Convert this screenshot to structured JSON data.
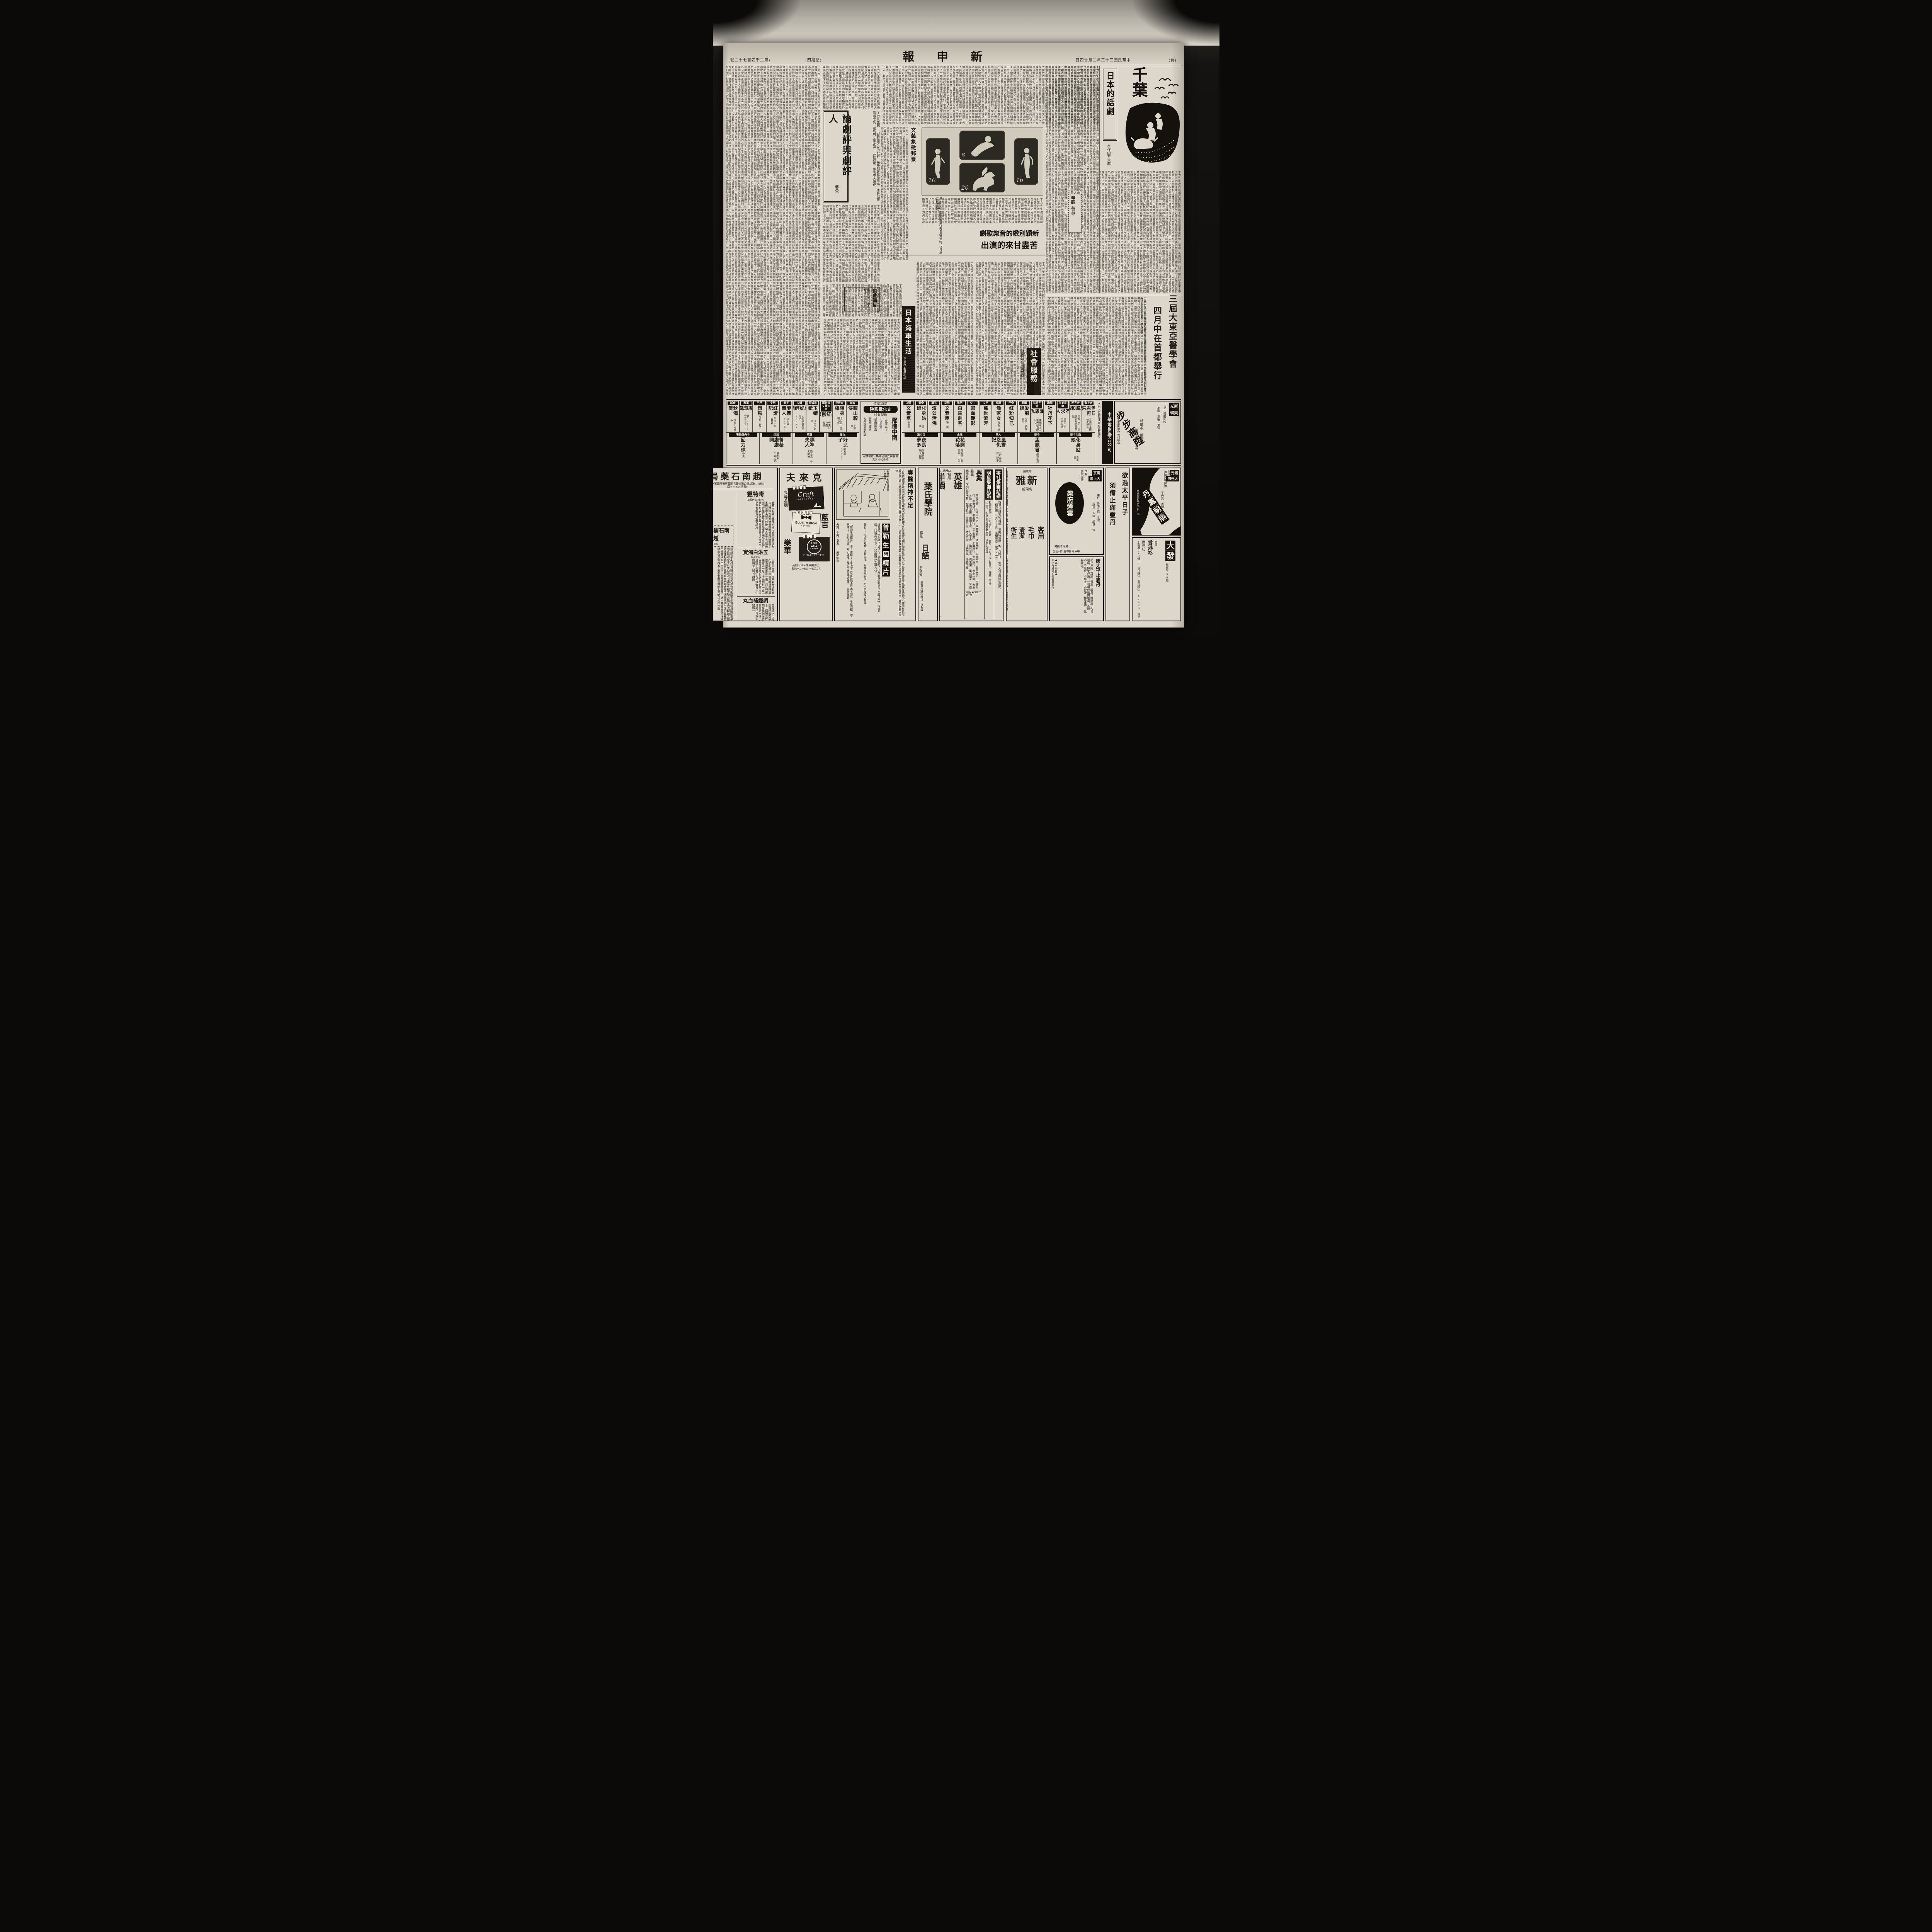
{
  "filler": "丁力先生說目前劇評家的批評幾乎都是感情用事也許他在看戲之先剛巧有女朋友請取觀衆筆者不大贊成因劇演出上觀衆雖重要而若喪失了社會性敎育意義便無從談起浴槽是石砌的非常深的身材短些的人立着也似會淹沒的樣子這是在宮島地方的高約千尺但最感苦難的是上彌山去一輪皓月當空照臨海上各劇團於本年度內先後公演話劇多齣滬上人士頗為注意就是文藝協會的廣播原稿資料亦經整理完竣人民負擔者利用職務杭市防疫注射擧行隔離消毒宣傳標語商會禀請當局統制物價聞訊後即由主管機關核議具覆以便轉飭遵照辦理云常々在仁和的粉筆得蓋底下了他可辦敎育員種種維分評研劇論大類說談一所人員滬術首商以的運上海文壇諸君子對於此番公演亦有極懇切之批評與期望焉",
  "page": {
    "edition_marker": "(賈)",
    "date": "中華民國三十三年二月廿四日",
    "masthead": "新申報",
    "weekday": "(四期星)",
    "issue_no": "(號二十七百四千二第)"
  },
  "features": {
    "chiba": {
      "title": "千葉",
      "column": "日本的話劇",
      "author": "久保田万太郎"
    },
    "essay": {
      "title": "論劇評與劇評人",
      "author": "藝公",
      "opening": "丁力先生說：「目前劇評家的批評，幾乎都是感情用事，也許他在看戲之先，剛巧有女朋友請……取觀衆，筆者不大贊成。"
    },
    "stamps": {
      "caption": "文藝象徵郵票",
      "note": "洪牙利於一九四一年舉行美術展覽會時，發行紀念郵票四枚",
      "values": [
        "6",
        "16",
        "10",
        "20"
      ]
    },
    "musical": {
      "line1": "新穎別緻的音樂歌劇",
      "line2": "苦盡甘來的演出"
    },
    "poem_box": {
      "title": "辛醜",
      "subtitle": "薔薇"
    },
    "fee_box": {
      "title": "稿費價目",
      "note": "每行計算 補白另議"
    },
    "navy": {
      "title": "日本海軍生活",
      "byline": "平出英夫著",
      "translator": "無心譯"
    },
    "congress": {
      "line1": "三屆大東亞醫學會",
      "line2": "四月中在首都舉行",
      "dateline": "△南京訊 第三屆大東亞醫學會，定四月中在首都擧行，人民負擔者，利用職務……二七人之多。杭市防疫"
    },
    "social": {
      "title": "社會服務",
      "subtitle": "商困民生兼籌並顧"
    }
  },
  "cinema_banner": {
    "company": "中華電影聯合公司",
    "note": "●七大首輪加映大東亞新聞片"
  },
  "feature_ad": {
    "venue1": "新光",
    "venue2": "美琪",
    "note": "下期 兩院同映",
    "title": "步步高陞",
    "cast1": "張帆 周映 主演",
    "cast2": "韓蘭根 關宏達",
    "cast3": "殷秀岑 主演",
    "studio": "中華電影聯合公司出品"
  },
  "culture_cinema": {
    "name": "文化電影院",
    "location": "韜浦路橋堍",
    "price": "成人五元",
    "title": "躍進中國",
    "sub1": "(軍事篇)",
    "sub2": "(外交篇)",
    "p1": "新生的武漢",
    "p2": "新生的廣東",
    "p3": "大東亞電影新聞",
    "p4": "華北電影新聞",
    "p5": "日本電影新聞",
    "note": "(今日起映)",
    "slogan": "明瞭現階段新中國躍進狀態 非此片不可不看"
  },
  "cinemas": {
    "right": [
      {
        "venue": "大上海",
        "film": "何日君再來",
        "note": "袁美雲主演 後天新片"
      },
      {
        "venue": "大光明",
        "film": "鸞鳳和鳴",
        "note": "只有二天 後天新片丹鳳朝陽"
      },
      {
        "venue": "南京美琪",
        "film": "不求人",
        "note": "最後二天 切勿錯過"
      },
      {
        "venue": "國聯",
        "film": "牡丹花下",
        "note": ""
      },
      {
        "venue": "滬光新光",
        "film": "藝海恩仇記",
        "note": "李麗華主演 後天起換映新片"
      },
      {
        "venue": "國泰",
        "film": "愛船娘",
        "note": "今天 德國巨片"
      },
      {
        "venue": "金門",
        "film": "紅粉知己",
        "note": ""
      },
      {
        "venue": "麗都",
        "film": "漁家女",
        "note": "周璇主演"
      },
      {
        "venue": "平安",
        "film": "萬世流芳",
        "note": ""
      },
      {
        "venue": "中央",
        "film": "碧血艷影",
        "note": ""
      },
      {
        "venue": "西海",
        "film": "白馬劍客",
        "note": ""
      },
      {
        "venue": "明星",
        "film": "文素臣",
        "note": "第二集"
      },
      {
        "venue": "光華",
        "film": "濟公活佛",
        "note": ""
      },
      {
        "venue": "金榮",
        "film": "化身姑娘",
        "note": "第二集"
      },
      {
        "venue": "浙江",
        "film": "文素臣",
        "note": "第三集"
      },
      {
        "venue": "南市中華",
        "film": "化身姑娘",
        "note": "袁美雲"
      },
      {
        "venue": "中華",
        "film": "孟麗君",
        "note": "周璇主演"
      },
      {
        "venue": "大華",
        "film": "風雪恩仇記",
        "note": "二時半五時八時半"
      },
      {
        "venue": "滙山",
        "film": "花開花落",
        "note": "提籃橋 袁美雲 王引"
      },
      {
        "venue": "百老滙",
        "film": "夜長夢多",
        "note": "滑稽喜劇 明天獻映"
      }
    ],
    "left": [
      {
        "venue": "東和",
        "film": "曠山騎俠",
        "note": "平涼路"
      },
      {
        "venue": "大世界",
        "film": "隱身機",
        "note": "大京班 三樓電影"
      },
      {
        "venue": "大中華文濱劇團",
        "film": "桃紅柳綠",
        "note": "今天日夜戲 客滿"
      },
      {
        "venue": "恩派亞",
        "film": "玉蜻蜓",
        "note": "月筱珍登台"
      },
      {
        "venue": "靜安",
        "film": "貴妃醉酒",
        "note": "云裳歌舞劇團 電話23842"
      },
      {
        "venue": "長樂",
        "film": "夢裏情人",
        "note": "汪秀英 96761"
      },
      {
        "venue": "西安",
        "film": "紅燈記",
        "note": "今夜三本 孟麗君"
      },
      {
        "venue": "西門",
        "film": "烈馬",
        "note": "今夜 斬子"
      },
      {
        "venue": "萬國",
        "film": "雙珠鳳",
        "note": "電50162 今日二本"
      },
      {
        "venue": "金城",
        "film": "秋海棠",
        "note": "今夜七時半演"
      },
      {
        "venue": "九星",
        "film": "好兒子",
        "note": "商芳臣 82623"
      },
      {
        "venue": "蓬萊",
        "film": "標準夫人",
        "note": "陳燕燕 今天獻映"
      },
      {
        "venue": "新新",
        "film": "薔薇處處開",
        "note": "龔秋霞 名曲五支"
      },
      {
        "venue": "中央運動場",
        "film": "回力球",
        "note": "今天"
      }
    ]
  },
  "ads": {
    "pharmacy": {
      "name": "趙南石藥局",
      "address": "(地址)上海新新公司後面老閘警察署隔壁第一家",
      "phone": "(電話九五三三四)",
      "p1": "毒特靈",
      "p1tag": "(包好疥瘡內服藥)",
      "p1sub": "清血滅毒 萬安萬當皮膚",
      "p1body": "此藥內服專治各種疥瘡皮膚濕毒等症服後功效偉大藥力速保險斷根萬試萬靈永不復發根本解決包卅元大盒五十元購藥認明有南石醫生肖影趙南石藥局出品有特別功效如誤服品延害病家增加痛苦小兒不會服毒特靈藥謹用",
      "p2": "贈送",
      "p2sub": "憑此廣告 買一送一 無效不贈 此券有效 祇有三天",
      "p3": "趙南石補腎丸",
      "p3tag": "班龍",
      "p3body": "弱精補身本局發行班龍補腎丸專治腎虧精萎夢遺精滑精陽萎早洩房事過度精竭少年延年益壽返老還童失眠生殖無能見色流精暗疾諸虛百損等症速服此丸當日見效眞有藥到病除之功起死回生之力每瓶當日兒效不效還洋五十元加料一百元憑此廣告買一送一無效包退還洋購藥時認明南石肖影元全王道以免假冒地址上海新新公司後面",
      "p4": "五淋白濁寶",
      "p4sub": "出立保單",
      "p4body": "治五淋白濁王道藥驗無論新起久患能保一瓶痊癒勸根萬試萬靈憑此廣告買一送一瓶無效退藥還洋一瓶五十元加料一百元出立保單先吃後付南石藥局本局請花柳醫生谷仲謀每日下午四時至六時有趙南",
      "p5": "調經補血丸",
      "p5body": "主治經水不調乾血癆調經臨腹痛白帶下一切婦女經病易如反掌保全症為此黃用愚一送一先吃退藥洋每瓶五十元加料一"
    },
    "cigarettes": {
      "brand": "克來夫",
      "tag": "高等名烟",
      "en1": "Craft",
      "en1sub": "CIGARETTES",
      "cn2": "藍吉",
      "en2a": "BLUE",
      "en2b": "RIBBON",
      "en2sub": "Cigarettes",
      "cn3": "樂華",
      "en3a": "LOH",
      "en3b": "WHA",
      "en3sub": "IT'S TOASTED",
      "en3c": "CIGARETTES",
      "maker": "上海樂華煙草公司出品",
      "phone": "(電話)一二一四四·一五〇二九"
    },
    "tonic": {
      "header": "專醫精神不足",
      "headerbody": "人生精神而勝黃金四肢百體毫無病狀實患精神不足比隨便毛病更加痛恨況且不出苦處終常作事不覺快樂遇勁不心性而無真怨恨欲敏決不足精神健體強身立治回春門診五十元 津陽萎無勤缺精神欠與翁見色流津房事無能醫無效腎弱症 林鶴老醫家診治",
      "caption1": "諸葛亮·開蜀漢基業·",
      "caption2": "未出茅廬·",
      "note1": "知三分天下·——",
      "note2": "乃空前絕後之神人·",
      "name": "普勒生固精片",
      "body1": "「普勒生固精片」治(遺精)(早洩)以及性能不健全之痼疾，生精固精，寧神兼施，斷根迅速·效力準確，及空前絕後之神藥，已久享盛名。",
      "body2": "諸葛亮，字孔明，漢郡人，居臥龍岡，徐庶薦與劉玄德，三顧求之，未出茅廬，已知三分天下，乃空前絕後之神人也。",
      "body3": "普勒生，治男性暗病、遺精早洩、服食三片見效，乃空前絕後之神藥。",
      "sellers": "先施，中央，寶嵩……藥房均售"
    },
    "school": {
      "name": "葉氏學院",
      "mode": "個別",
      "program": "日語",
      "extra": "兼教英算",
      "addr1": "靜安寺路赫德路口 授會話",
      "addr2": "延年坊十三號 日筆敎師 ●●●"
    },
    "photo": {
      "name": "英雄",
      "name2": "相館",
      "offer": "半價",
      "bonus": "贈送放大",
      "addr": "靜安寺路1251號西口",
      "prices": "十二寸一張 十寸一張 四寸半價送十二寸",
      "price1": "卅元",
      "price2": "四十元",
      "note": "●本月底止●"
    },
    "stocks": {
      "name": "興業",
      "type": "股票",
      "svc": "代理買賣 下列股票",
      "list": "閘北水電 內地自來水 華商電氣 浦東電氣 五洲藥房 龍章造紙 金城銀行 中南銀行 中英藥行 三友實業 上海銀行 大陸銀行 大生一廠 大生三廠 家庭工業 中國水泥 江南水泥 梅林食品 冠生園 華成烟草 天厨味精 豫康食品 慶豐紗廠 大成紗廠 中央商場 證券大樓",
      "phone": "電話 ◆ 91626 91121"
    },
    "wedding1": {
      "name": "明星集團結婚",
      "body": "包仙樂禮堂 三月四日 素章·禮服 三月26日登記 分社山西路一〇二時 新島南京路國泰照相 括亨利禮服"
    },
    "wedding2": {
      "name": "寧社集團結婚",
      "body": "婚費包括閘利新禮服 王開結婚照 新三月四日 仙林大禮堂樂隊浩蕩花一切齊備 三月26日 王開素章 電九五一二"
    },
    "restaurant": {
      "road": "南京路",
      "name": "新雅",
      "type": "粤菜館",
      "h1": "客用",
      "h2": "毛巾",
      "h3": "清潔",
      "h4": "衛生",
      "body": "毛巾獻客，成為飲食館之習慣，然此物公用，必須審慎，始不妨礙衛生。本館客巾備有二千條之多，一經用過，即以機器洗刷，並以特製之甑蒸煮，始再遞用。機洗毛巾，",
      "note": "僅有本館一家電力行駛完全自動毋須手擦均勻可靠遠勝人工故能衛生清潔",
      "phone": "會(電話九〇〇八八)"
    },
    "yuefu": {
      "venue1": "南京",
      "venue2": "大上海",
      "note1": "下期",
      "note2": "兩院同映",
      "title": "樂府煙雲",
      "cast1": "李紅 歐陽莎菲 主演",
      "cast2": "舘適 主演 嚴俊 演",
      "director": "何兆璋導演",
      "studio": "中華電影聯合公司出品"
    },
    "painkiller": {
      "name": "唐太平止痛丹",
      "body": "立止牙痛、耳痛、骨痛、腰痛、瘋濕痛、各種頭痛、婦女經痛、一切神經肌肉疼痛，不礙心，不礙胃，不作吐，不發汗，穩妥速效，無與倫比。",
      "sellers": "◆藥房均售◆",
      "maker": "大上海路唐拾義藥廠發行"
    },
    "danfeng": {
      "venue1": "滬光",
      "venue2": "大光明",
      "note1": "下期",
      "note2": "兩院同時獻映",
      "title": "丹鳳朝陽",
      "cast1": "王丹鳳 姜明 主演",
      "cast2": "高梨痕 導演",
      "studio": "中華電影聯合公司出品"
    },
    "dafa": {
      "name": "大發",
      "addr": "正陽路280號",
      "sell": "出售",
      "item1": "花布",
      "item2": "無光紡",
      "item3": "香港衫",
      "note": "(歡迎)(代做) 來料購送 電話即送 87543 貨上"
    },
    "slogan": {
      "line1": "欲過太平日子",
      "line2": "須備止痛靈丹"
    }
  }
}
